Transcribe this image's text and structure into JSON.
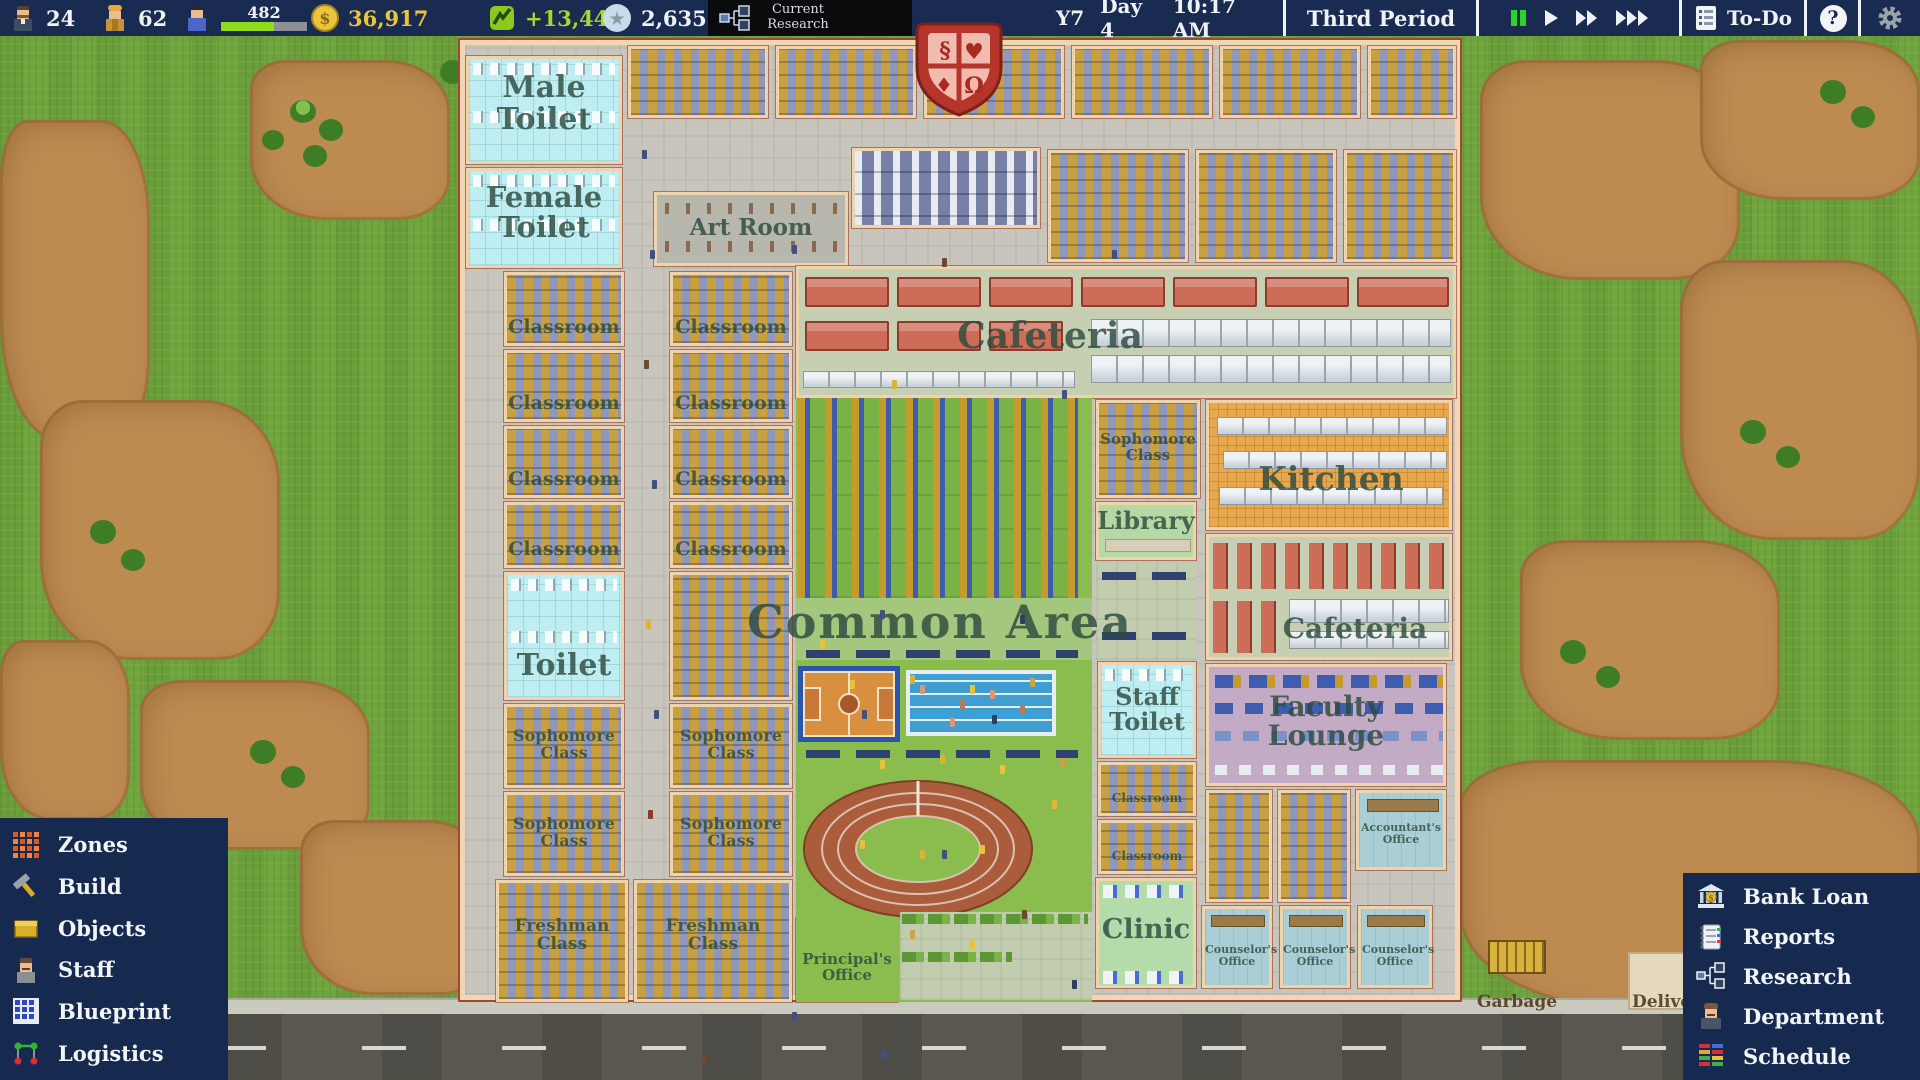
{
  "topbar": {
    "teacher_count": "24",
    "worker_count": "62",
    "student_count": "482",
    "money": "36,917",
    "income": "+13,448",
    "prestige": "2,635",
    "research_label": "Current Research",
    "year": "Y7",
    "day": "Day 4",
    "time": "10:17 AM",
    "period": "Third Period",
    "todo_label": "To-Do",
    "help_label": "?"
  },
  "left_menu": {
    "items": [
      {
        "label": "Zones"
      },
      {
        "label": "Build"
      },
      {
        "label": "Objects"
      },
      {
        "label": "Staff"
      },
      {
        "label": "Blueprint"
      },
      {
        "label": "Logistics"
      }
    ]
  },
  "right_menu": {
    "items": [
      {
        "label": "Bank Loan"
      },
      {
        "label": "Reports"
      },
      {
        "label": "Research"
      },
      {
        "label": "Department"
      },
      {
        "label": "Schedule"
      }
    ]
  },
  "map": {
    "labels": {
      "male_toilet": "Male Toilet",
      "female_toilet": "Female Toilet",
      "toilet": "Toilet",
      "staff_toilet": "Staff Toilet",
      "classroom": "Classroom",
      "sophomore_class": "Sophomore Class",
      "freshman_class": "Freshman Class",
      "art_room": "Art Room",
      "cafeteria": "Cafeteria",
      "kitchen": "Kitchen",
      "library": "Library",
      "common_area": "Common Area",
      "faculty_lounge": "Faculty Lounge",
      "principals_office": "Principal's Office",
      "clinic": "Clinic",
      "counselors_office": "Counselor's Office",
      "accountants_office": "Accountant's Office",
      "garbage": "Garbage",
      "delivery": "Delivery"
    }
  }
}
